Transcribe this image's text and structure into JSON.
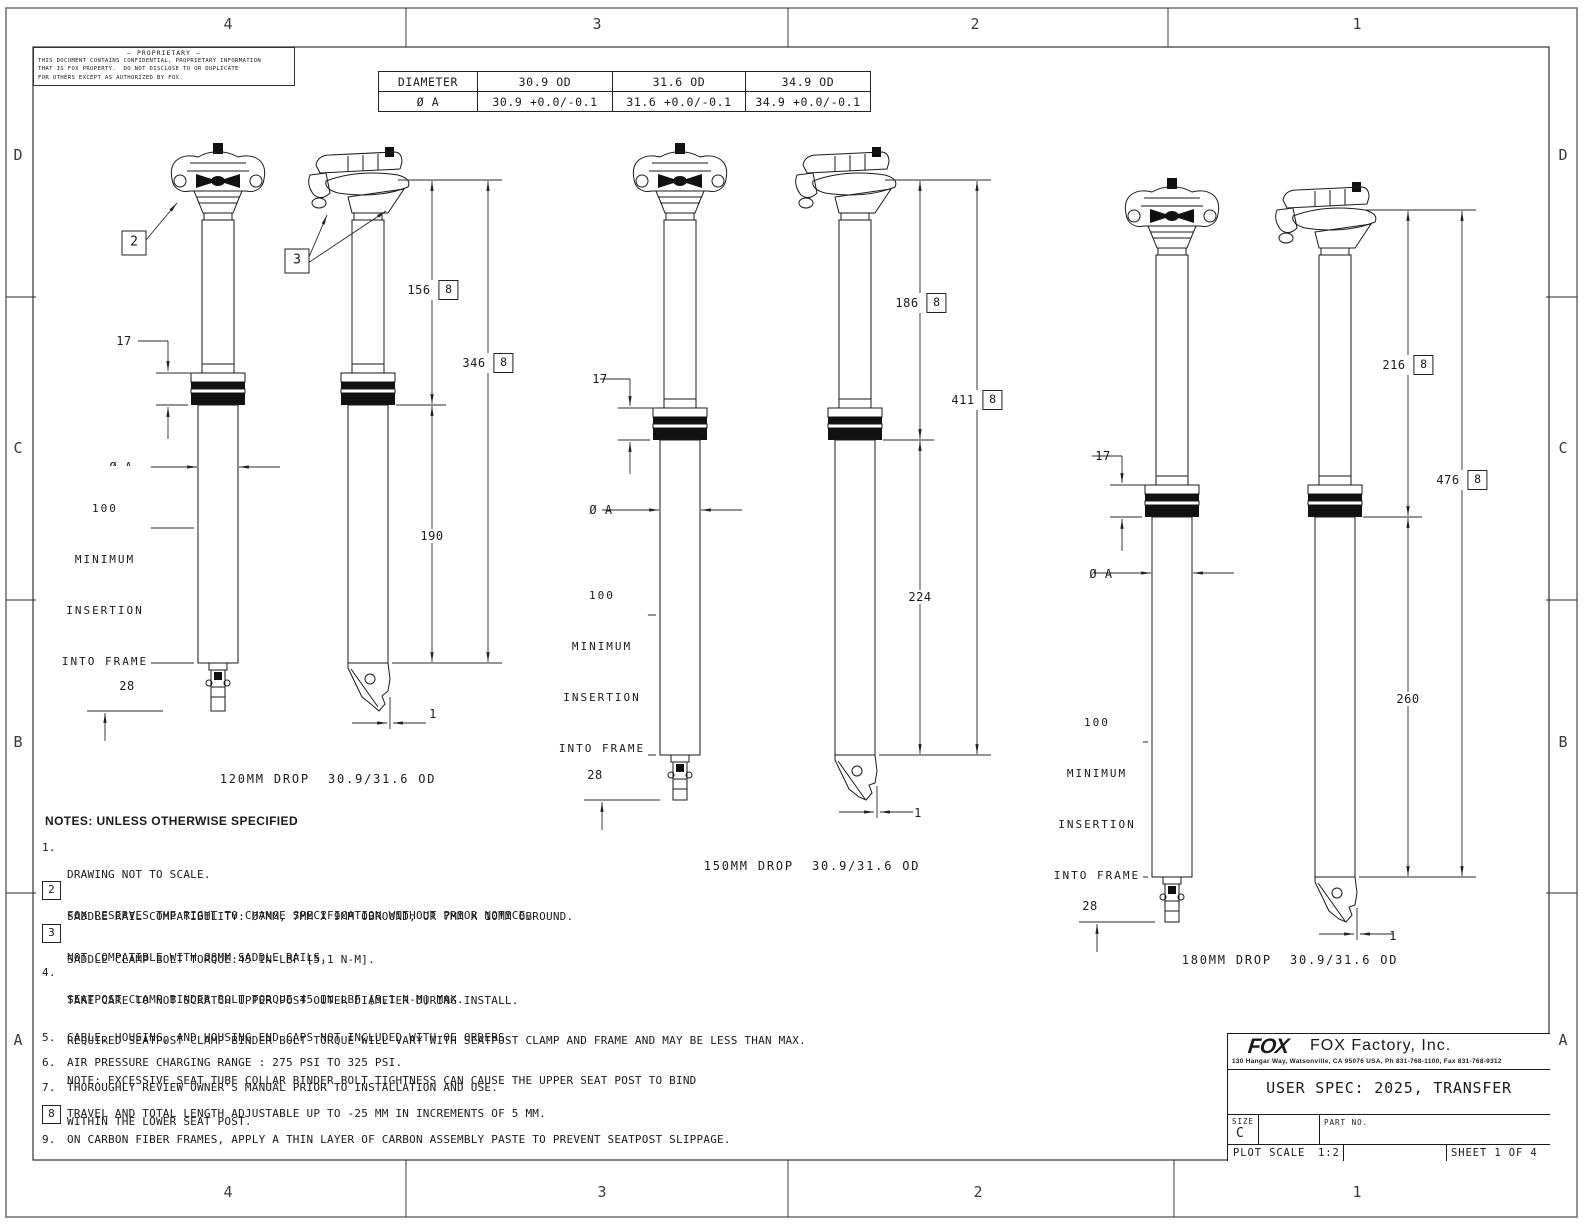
{
  "border": {
    "columns": [
      "4",
      "3",
      "2",
      "1"
    ],
    "rows": [
      "D",
      "C",
      "B",
      "A"
    ]
  },
  "proprietary": {
    "title": "— PROPRIETARY —",
    "lines": [
      "THIS DOCUMENT CONTAINS CONFIDENTIAL, PROPRIETARY INFORMATION",
      "THAT IS FOX PROPERTY.  DO NOT DISCLOSE TO OR DUPLICATE",
      "FOR OTHERS EXCEPT AS AUTHORIZED BY FOX."
    ]
  },
  "diameter_table": {
    "rows": [
      [
        "DIAMETER",
        "30.9 OD",
        "31.6 OD",
        "34.9 OD"
      ],
      [
        "Ø A",
        "30.9 +0.0/-0.1",
        "31.6 +0.0/-0.1",
        "34.9 +0.0/-0.1"
      ]
    ]
  },
  "drawings": [
    {
      "caption": "120MM DROP  30.9/31.6 OD",
      "callout_saddle": "2",
      "callout_clamp": "3",
      "dim_collar": "17",
      "dim_diameter": "Ø A",
      "insertion_lines": [
        "100",
        "MINIMUM",
        "INSERTION",
        "INTO FRAME"
      ],
      "dim_bottom": "28",
      "dim_drop": "156",
      "dim_total": "346",
      "dim_lower": "190",
      "dim_offset": "1",
      "note_ref": "8"
    },
    {
      "caption": "150MM DROP  30.9/31.6 OD",
      "dim_collar": "17",
      "dim_diameter": "Ø A",
      "insertion_lines": [
        "100",
        "MINIMUM",
        "INSERTION",
        "INTO FRAME"
      ],
      "dim_bottom": "28",
      "dim_drop": "186",
      "dim_total": "411",
      "dim_lower": "224",
      "dim_offset": "1",
      "note_ref": "8"
    },
    {
      "caption": "180MM DROP  30.9/31.6 OD",
      "dim_collar": "17",
      "dim_diameter": "Ø A",
      "insertion_lines": [
        "100",
        "MINIMUM",
        "INSERTION",
        "INTO FRAME"
      ],
      "dim_bottom": "28",
      "dim_drop": "216",
      "dim_total": "476",
      "dim_lower": "260",
      "dim_offset": "1",
      "note_ref": "8"
    }
  ],
  "notes": {
    "heading": "NOTES: UNLESS OTHERWISE SPECIFIED",
    "items": [
      {
        "num": "1.",
        "boxed": false,
        "lines": [
          "DRAWING NOT TO SCALE.",
          "FOX RESERVES THE RIGHT TO CHANGE SPECIFICATION WITHOUT PRIOR NOTICE."
        ]
      },
      {
        "num": "2",
        "boxed": true,
        "lines": [
          "SADDLE RAIL COMPATIBILITY: Ø7MM, 7MM X 9MM OBROUND, OR 7MM X 10MM OBROUND.",
          "NOT COMPATIBLE WITH Ø8MM SADDLE RAILS."
        ]
      },
      {
        "num": "3",
        "boxed": true,
        "lines": [
          "SADDLE CLAMP BOLT TORQUE:45 IN-LBF [5,1 N-M].",
          "TAKE CARE TO NOT SCRATCH UPPER POST OUTER DIAMETER DURING INSTALL."
        ]
      },
      {
        "num": "4.",
        "boxed": false,
        "lines": [
          "SEATPOST CLAMP BINDER BOLT TORQUE 45 IN-LBF [5,1 N-M] MAX.",
          "REQUIRED SEATPOST CLAMP BINDER BOLT TORQUE WILL VARY WITH SEATPOST CLAMP AND FRAME AND MAY BE LESS THAN MAX.",
          "NOTE: EXCESSIVE SEAT TUBE COLLAR BINDER BOLT TIGHTNESS CAN CAUSE THE UPPER SEAT POST TO BIND",
          "WITHIN THE LOWER SEAT POST."
        ]
      },
      {
        "num": "5.",
        "boxed": false,
        "lines": [
          "CABLE, HOUSING, AND HOUSING END CAPS NOT INCLUDED WITH OE ORDERS."
        ]
      },
      {
        "num": "6.",
        "boxed": false,
        "lines": [
          "AIR PRESSURE CHARGING RANGE : 275 PSI TO 325 PSI."
        ]
      },
      {
        "num": "7.",
        "boxed": false,
        "lines": [
          "THOROUGHLY REVIEW OWNER'S MANUAL PRIOR TO INSTALLATION AND USE."
        ]
      },
      {
        "num": "8",
        "boxed": true,
        "lines": [
          "TRAVEL AND TOTAL LENGTH ADJUSTABLE UP TO -25 MM IN INCREMENTS OF 5 MM."
        ]
      },
      {
        "num": "9.",
        "boxed": false,
        "lines": [
          "ON CARBON FIBER FRAMES, APPLY A THIN LAYER OF CARBON ASSEMBLY PASTE TO PREVENT SEATPOST SLIPPAGE."
        ]
      }
    ]
  },
  "title_block": {
    "logo": "FOX",
    "company": "FOX Factory, Inc.",
    "address": "130 Hangar Way, Watsonville, CA 95076 USA, Ph 831-768-1100, Fax 831-768-9312",
    "spec": "USER SPEC: 2025, TRANSFER",
    "size_label": "SIZE",
    "size_value": "C",
    "part_label": "PART NO.",
    "plot_label": "PLOT SCALE",
    "plot_value": "1:2",
    "sheet": "SHEET 1 OF 4"
  }
}
